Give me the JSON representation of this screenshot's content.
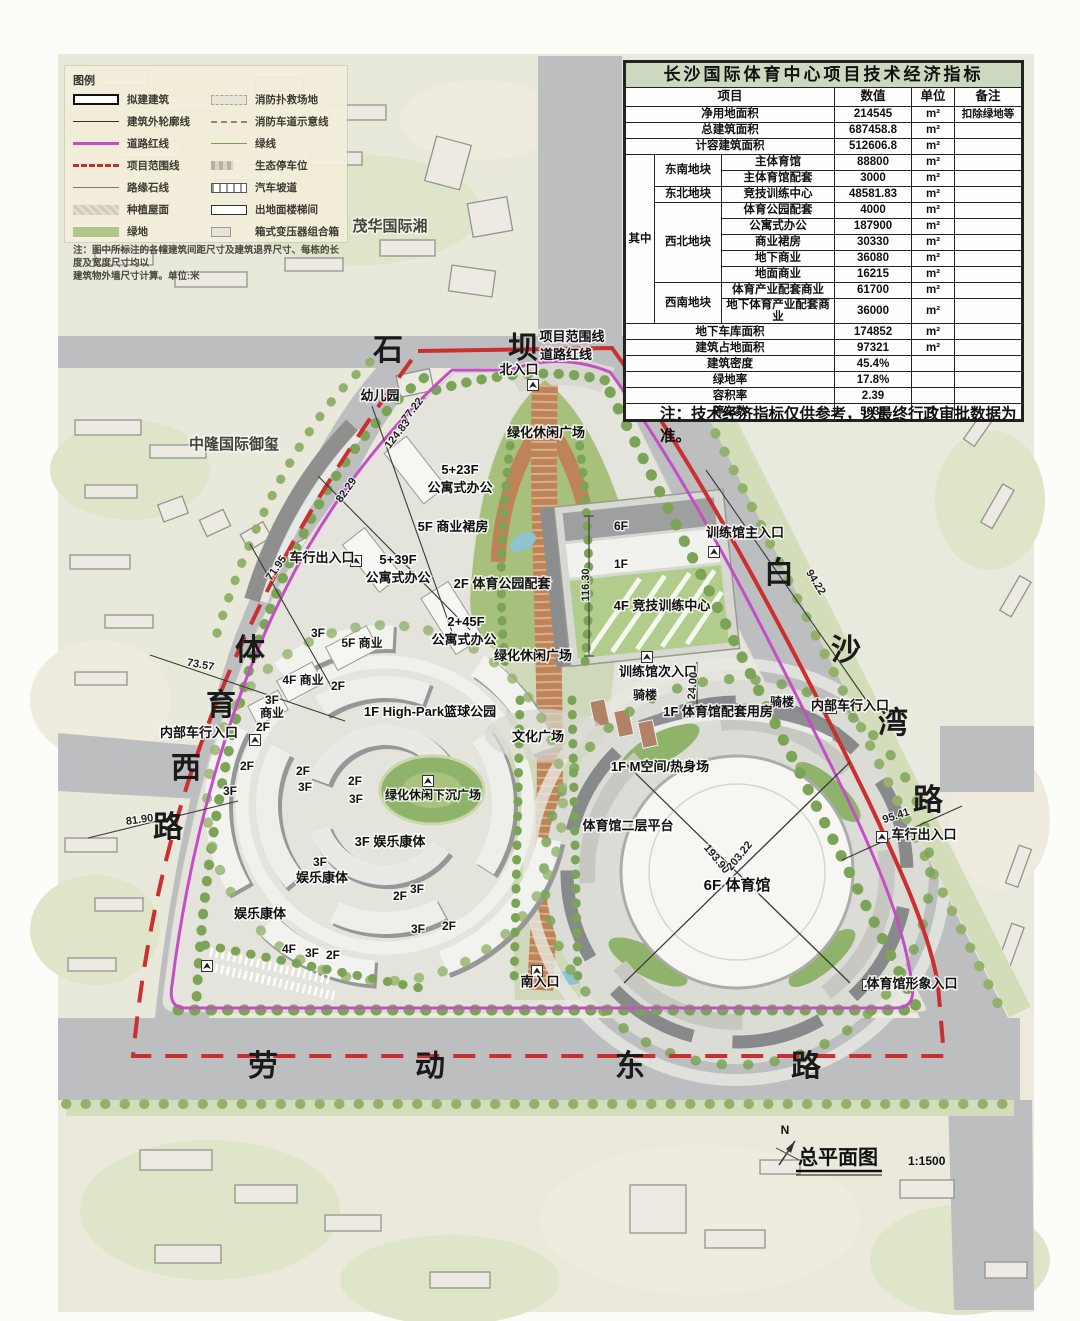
{
  "table": {
    "title": "长沙国际体育中心项目技术经济指标",
    "headers": [
      "项目",
      "数值",
      "单位",
      "备注"
    ],
    "group_label": "其中",
    "rows": [
      {
        "item": "净用地面积",
        "value": "214545",
        "unit": "m²",
        "note": "扣除绿地等"
      },
      {
        "item": "总建筑面积",
        "value": "687458.8",
        "unit": "m²",
        "note": ""
      },
      {
        "item": "计容建筑面积",
        "value": "512606.8",
        "unit": "m²",
        "note": ""
      },
      {
        "block": "东南地块",
        "item": "主体育馆",
        "value": "88800",
        "unit": "m²",
        "note": ""
      },
      {
        "item": "主体育馆配套",
        "value": "3000",
        "unit": "m²",
        "note": ""
      },
      {
        "block": "东北地块",
        "item": "竞技训练中心",
        "value": "48581.83",
        "unit": "m²",
        "note": ""
      },
      {
        "block": "西北地块",
        "item": "体育公园配套",
        "value": "4000",
        "unit": "m²",
        "note": ""
      },
      {
        "item": "公寓式办公",
        "value": "187900",
        "unit": "m²",
        "note": ""
      },
      {
        "item": "商业裙房",
        "value": "30330",
        "unit": "m²",
        "note": ""
      },
      {
        "item": "地下商业",
        "value": "36080",
        "unit": "m²",
        "note": ""
      },
      {
        "item": "地面商业",
        "value": "16215",
        "unit": "m²",
        "note": ""
      },
      {
        "block": "西南地块",
        "item": "体育产业配套商业",
        "value": "61700",
        "unit": "m²",
        "note": ""
      },
      {
        "item": "地下体育产业配套商业",
        "value": "36000",
        "unit": "m²",
        "note": ""
      },
      {
        "item": "地下车库面积",
        "value": "174852",
        "unit": "m²",
        "note": ""
      },
      {
        "item": "建筑占地面积",
        "value": "97321",
        "unit": "m²",
        "note": ""
      },
      {
        "item": "建筑密度",
        "value": "45.4%",
        "unit": "",
        "note": ""
      },
      {
        "item": "绿地率",
        "value": "17.8%",
        "unit": "",
        "note": ""
      },
      {
        "item": "容积率",
        "value": "2.39",
        "unit": "",
        "note": ""
      },
      {
        "item": "停车数",
        "value": "5038",
        "unit": "个",
        "note": ""
      }
    ],
    "note": "注：技术经济指标仅供参考，以最终行政审批数据为准。"
  },
  "legend": {
    "title": "图例",
    "left": [
      {
        "label": "拟建建筑",
        "symbol": "planned-building"
      },
      {
        "label": "建筑外轮廓线",
        "symbol": "building-outline-line"
      },
      {
        "label": "道路红线",
        "symbol": "road-red-line"
      },
      {
        "label": "项目范围线",
        "symbol": "project-boundary-line"
      },
      {
        "label": "路缘石线",
        "symbol": "curb-line"
      },
      {
        "label": "种植屋面",
        "symbol": "planted-roof"
      },
      {
        "label": "绿地",
        "symbol": "green-space"
      }
    ],
    "right": [
      {
        "label": "消防扑救场地",
        "symbol": "fire-rescue-area"
      },
      {
        "label": "消防车道示意线",
        "symbol": "fire-lane-line"
      },
      {
        "label": "绿线",
        "symbol": "green-line"
      },
      {
        "label": "生态停车位",
        "symbol": "eco-parking"
      },
      {
        "label": "汽车坡道",
        "symbol": "car-ramp"
      },
      {
        "label": "出地面楼梯间",
        "symbol": "ground-stairwell"
      },
      {
        "label": "箱式变压器组合箱",
        "symbol": "transformer-box"
      }
    ],
    "note_line1": "注：图中所标注的各幢建筑间距尺寸及建筑退界尺寸、每栋的长度及宽度尺寸均以",
    "note_line2": "建筑物外墙尺寸计算。单位:米"
  },
  "map": {
    "roads": {
      "top": [
        "石",
        "坝"
      ],
      "right": [
        "白",
        "沙",
        "湾",
        "路"
      ],
      "left": [
        "体",
        "育",
        "西",
        "路"
      ],
      "bottom": [
        "劳",
        "动",
        "东",
        "路"
      ]
    },
    "districts": {
      "maohua": "茂华国际湘",
      "zhonglong": "中隆国际御玺",
      "kindergarten": "幼儿园"
    },
    "labels": {
      "project_boundary": "项目范围线",
      "road_redline": "道路红线",
      "north_entrance": "北入口",
      "south_entrance": "南入口",
      "green_plaza": "绿化休闲广场",
      "sunken_plaza": "绿化休闲下沉广场",
      "culture_plaza": "文化广场",
      "apt_5_23": "5+23F",
      "apt_5_39": "5+39F",
      "apt_2_45": "2+45F",
      "apt_office": "公寓式办公",
      "podium5f": "5F 商业裙房",
      "park_support": "2F 体育公园配套",
      "training_center": "4F 竞技训练中心",
      "training_main": "训练馆主入口",
      "training_sub": "训练馆次入口",
      "qilou": "骑楼",
      "internal_vehicle": "内部车行入口",
      "vehicle_exit": "车行出入口",
      "gym_support": "1F 体育馆配套用房",
      "m_space": "1F M空间/热身场",
      "gym_platform": "体育馆二层平台",
      "gym": "6F 体育馆",
      "gym_image": "体育馆形象入口",
      "highpark": "1F High-Park篮球公园",
      "ent3f": "3F 娱乐康体",
      "entertainment": "娱乐康体",
      "comm5": "5F 商业",
      "comm4": "4F 商业",
      "comm_word": "商业"
    },
    "floor_tags": {
      "f1": "1F",
      "f2": "2F",
      "f3": "3F",
      "f4": "4F",
      "f5": "5F",
      "f6": "6F"
    },
    "dims": {
      "d77": "77.22",
      "d124": "124.83",
      "d82": "82.29",
      "d71": "71.95",
      "d73": "73.57",
      "d81": "81.90",
      "d94": "94.22",
      "d95": "95.41",
      "d116": "116.30",
      "d24": "24.00",
      "d193": "193.90",
      "d203": "203.22"
    },
    "colors": {
      "road": "#bdbec0",
      "green": "#a7c17d",
      "boundary_red": "#cb2f2f",
      "redline_magenta": "#c44fc4",
      "boardwalk_orange": "#bf8455",
      "water": "#8fc3d4"
    }
  },
  "title_block": {
    "north": "N",
    "title": "总平面图",
    "scale": "1:1500"
  }
}
